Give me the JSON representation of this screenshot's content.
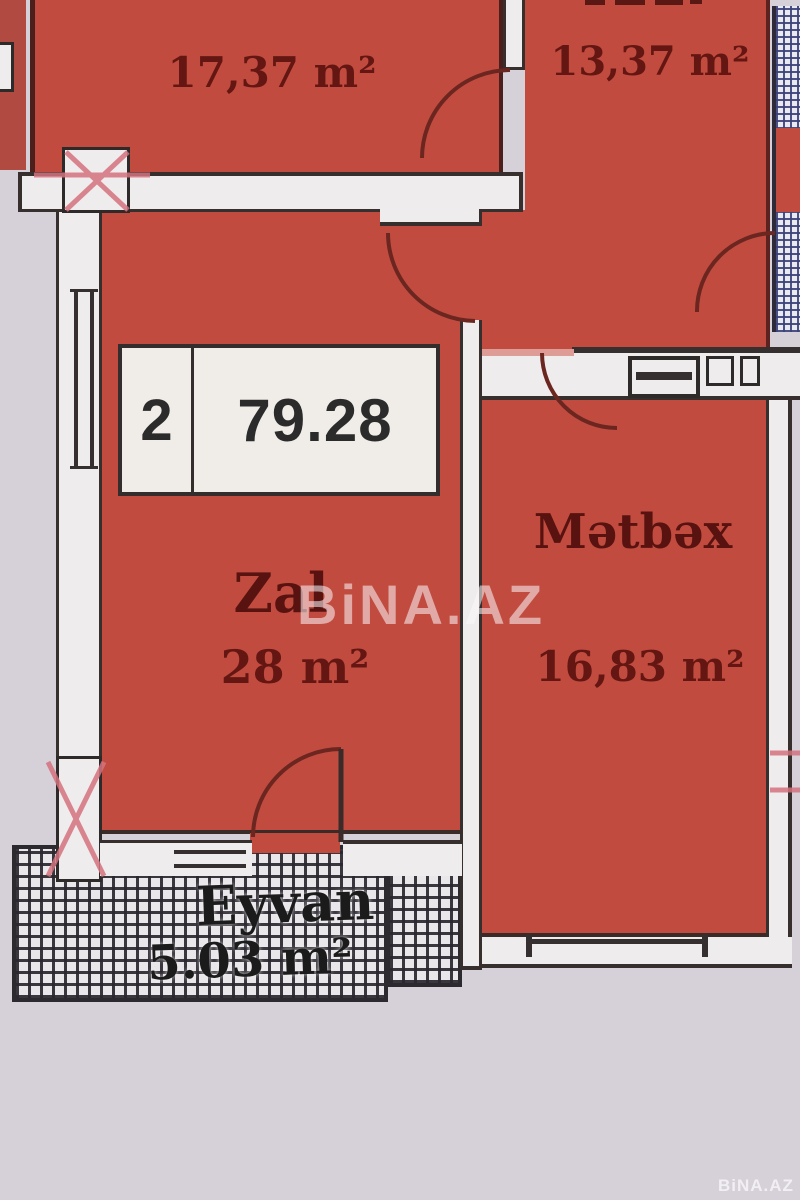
{
  "watermarks": {
    "center": "BiNA.AZ",
    "corner": "BiNA.AZ"
  },
  "unit_info": {
    "room_count": "2",
    "total_area": "79.28"
  },
  "rooms": [
    {
      "id": "bedroom-top-left",
      "name": "",
      "area": "17,37 m²"
    },
    {
      "id": "bedroom-top-right",
      "name": "",
      "area": "13,37 m²"
    },
    {
      "id": "living-room",
      "name": "Zal",
      "area": "28 m²"
    },
    {
      "id": "kitchen",
      "name": "Mətbəx",
      "area": "16,83 m²"
    },
    {
      "id": "balcony",
      "name": "Eyvan",
      "area": "5.03 m²"
    }
  ],
  "colors": {
    "room_fill": "#c24b40",
    "wall_fill": "#efecee",
    "outside": "#d6d1d8",
    "balcony_hatch": "#2a282e",
    "side_balcony_hatch_blue": "#3a407a",
    "joint_marker_pink": "#d4737f",
    "label_text": "#641712"
  }
}
